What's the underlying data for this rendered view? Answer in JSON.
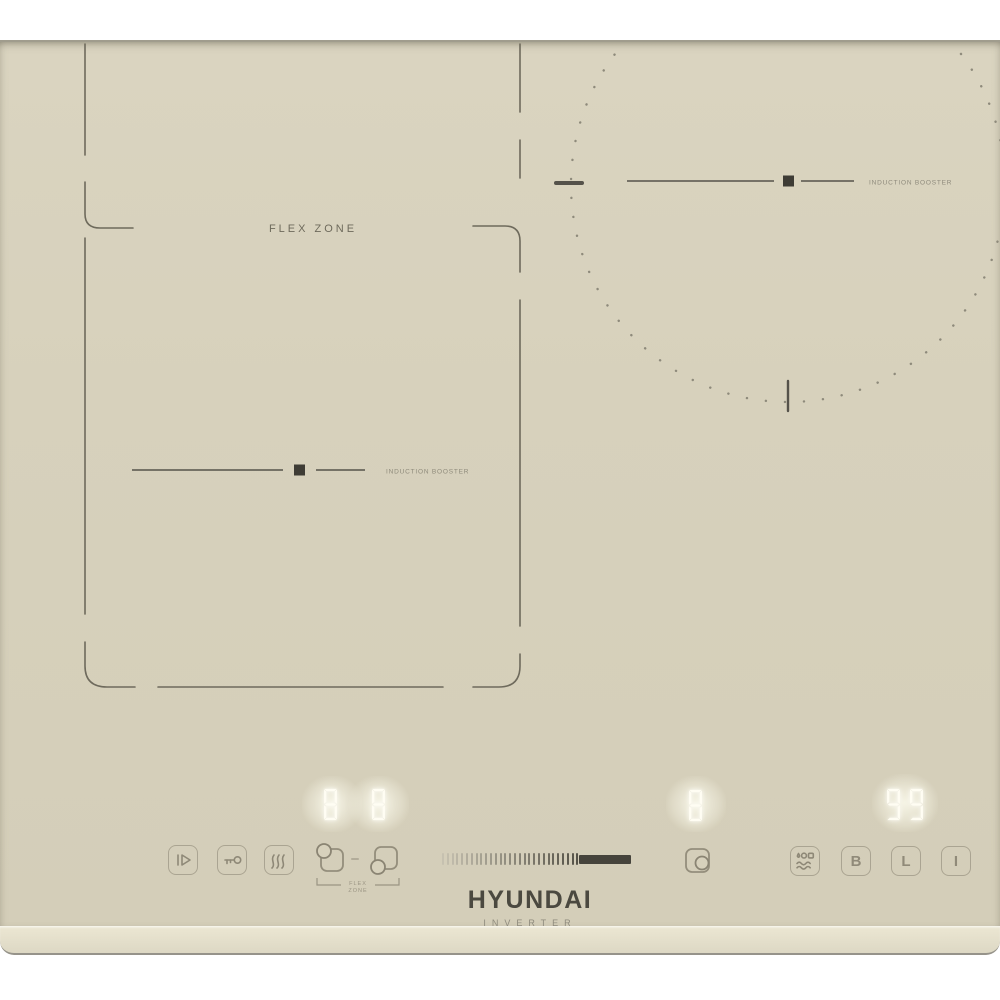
{
  "brand": {
    "name": "HYUNDAI",
    "subtitle": "INVERTER"
  },
  "surface": {
    "flex_zone_label": "FLEX ZONE",
    "left_zone_booster_label": "INDUCTION BOOSTER",
    "right_zone_booster_label": "INDUCTION BOOSTER"
  },
  "displays": {
    "flex_rear": "8",
    "flex_front": "8",
    "right_zone": "8",
    "timer": "99"
  },
  "controls": {
    "power_icon": "power-play-icon",
    "child_lock_icon": "key-icon",
    "keep_warm_icon": "heat-waves-icon",
    "flex_selector_label_line1": "FLEX",
    "flex_selector_label_line2": "ZONE",
    "boil_icon": "boil-steam-icon",
    "booster_label": "B",
    "lock_label": "L",
    "onoff_label": "I"
  },
  "slider": {
    "tick_count": 29,
    "tick_spacing": 4.8,
    "bar_width": 52,
    "active_ratio": 0.73
  },
  "colors": {
    "glass": "#d7d1bc",
    "zone_line": "#6e6a5c",
    "marker_dark": "#3e3c35",
    "digit": "#fffdf3",
    "slider_bar": "#46443c",
    "control_stroke": "#8e8877"
  }
}
